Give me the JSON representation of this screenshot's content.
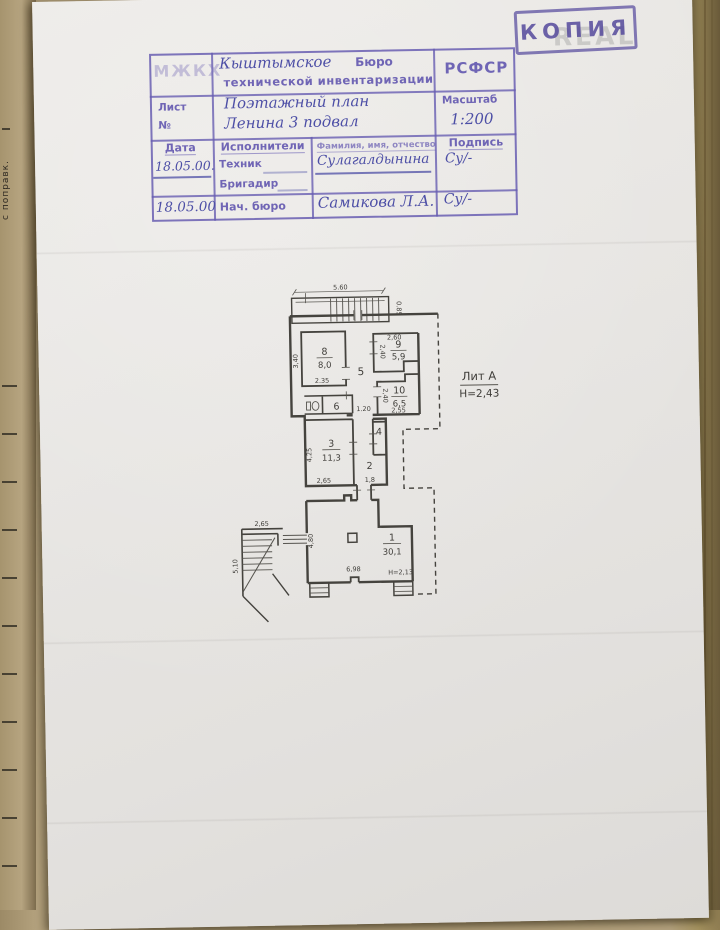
{
  "page": {
    "copy_stamp": "КОПИЯ",
    "watermark_text": "REAL",
    "binding_text": "с поправк.",
    "stamp": {
      "org_abbr": "МЖКХ",
      "org_city": "Кыштымское",
      "org_word_bureau": "Бюро",
      "org_line2": "технической инвентаризации",
      "org_republic": "РСФСР",
      "sheet_label": "Лист",
      "sheet_no_label": "№",
      "doc_title_line1": "Поэтажный план",
      "doc_title_line2": "Ленина 3 подвал",
      "scale_label": "Масштаб",
      "scale_value": "1:200",
      "col_date": "Дата",
      "col_executors": "Исполнители",
      "col_fio": "Фамилия, имя, отчество",
      "col_signature": "Подпись",
      "row_technician": {
        "date": "18.05.00.",
        "role": "Техник",
        "name": "Сулагалдынина",
        "sign": "Су/-"
      },
      "row_brigadir": {
        "role": "Бригадир"
      },
      "row_chief": {
        "date": "18.05.00",
        "role": "Нач. бюро",
        "name": "Самикова Л.А.",
        "sign": "Су/-"
      }
    },
    "plan": {
      "liter": "Лит А",
      "liter_height": "Н=2,43",
      "rooms": {
        "r1": {
          "num": "1",
          "area": "30,1"
        },
        "r2": {
          "num": "2"
        },
        "r3": {
          "num": "3",
          "area": "11,3"
        },
        "r4": {
          "num": "4"
        },
        "r5": {
          "num": "5"
        },
        "r6": {
          "num": "6"
        },
        "r8": {
          "num": "8",
          "area": "8,0"
        },
        "r9": {
          "num": "9",
          "area": "5,9"
        },
        "r10": {
          "num": "10",
          "area": "6,5"
        }
      },
      "dims": {
        "top_width": "5.60",
        "top_depth": "0.85",
        "r8_h": "3,40",
        "r8_w": "2.35",
        "r9_w": "2,60",
        "r9_h": "2,40",
        "r10_h": "2,40",
        "r10_w": "2,55",
        "corridor": "1.20",
        "r3_h": "4,25",
        "r3_w": "2,65",
        "r2_w": "1,8",
        "stair_w": "2,65",
        "stair_h": "5,10",
        "r1_h": "4,80",
        "r1_w": "6,98",
        "r1_ceiling": "Н=2,13"
      }
    }
  }
}
